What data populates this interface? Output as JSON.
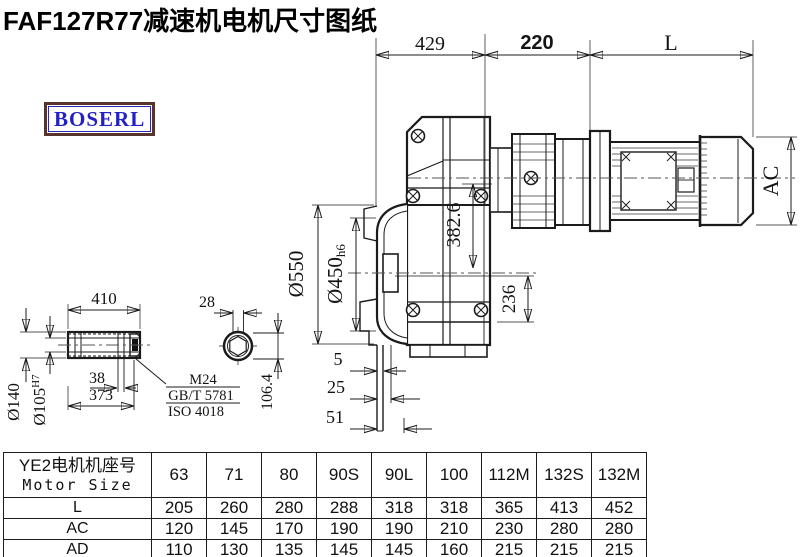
{
  "title": "FAF127R77减速机电机尺寸图纸",
  "logo": {
    "text": "BOSERL"
  },
  "drawing": {
    "top": {
      "d429": "429",
      "d220": "220",
      "dL": "L"
    },
    "right": {
      "ac": "AC"
    },
    "left": {
      "d550": "Ø550",
      "d450": "Ø450",
      "d450_tol": "h6"
    },
    "inner": {
      "d382": "382.6",
      "d236": "236"
    },
    "bottom": {
      "d5": "5",
      "d25": "25",
      "d51": "51"
    },
    "shaft": {
      "d410": "410",
      "d28": "28",
      "d140": "Ø140",
      "d105": "Ø105",
      "d105_tol": "H7",
      "d38": "38",
      "d373": "373",
      "d1064": "106.4",
      "m24": "M24",
      "gbt": "GB/T 5781",
      "iso": "ISO 4018"
    }
  },
  "table": {
    "header_line1": "YE2电机机座号",
    "header_line2": "Motor Size",
    "columns": [
      "63",
      "71",
      "80",
      "90S",
      "90L",
      "100",
      "112M",
      "132S",
      "132M"
    ],
    "rows": [
      {
        "label": "L",
        "values": [
          "205",
          "260",
          "280",
          "288",
          "318",
          "318",
          "365",
          "413",
          "452"
        ]
      },
      {
        "label": "AC",
        "values": [
          "120",
          "145",
          "170",
          "190",
          "190",
          "210",
          "230",
          "280",
          "280"
        ]
      },
      {
        "label": "AD",
        "values": [
          "110",
          "130",
          "135",
          "145",
          "145",
          "160",
          "215",
          "215",
          "215"
        ]
      }
    ]
  }
}
